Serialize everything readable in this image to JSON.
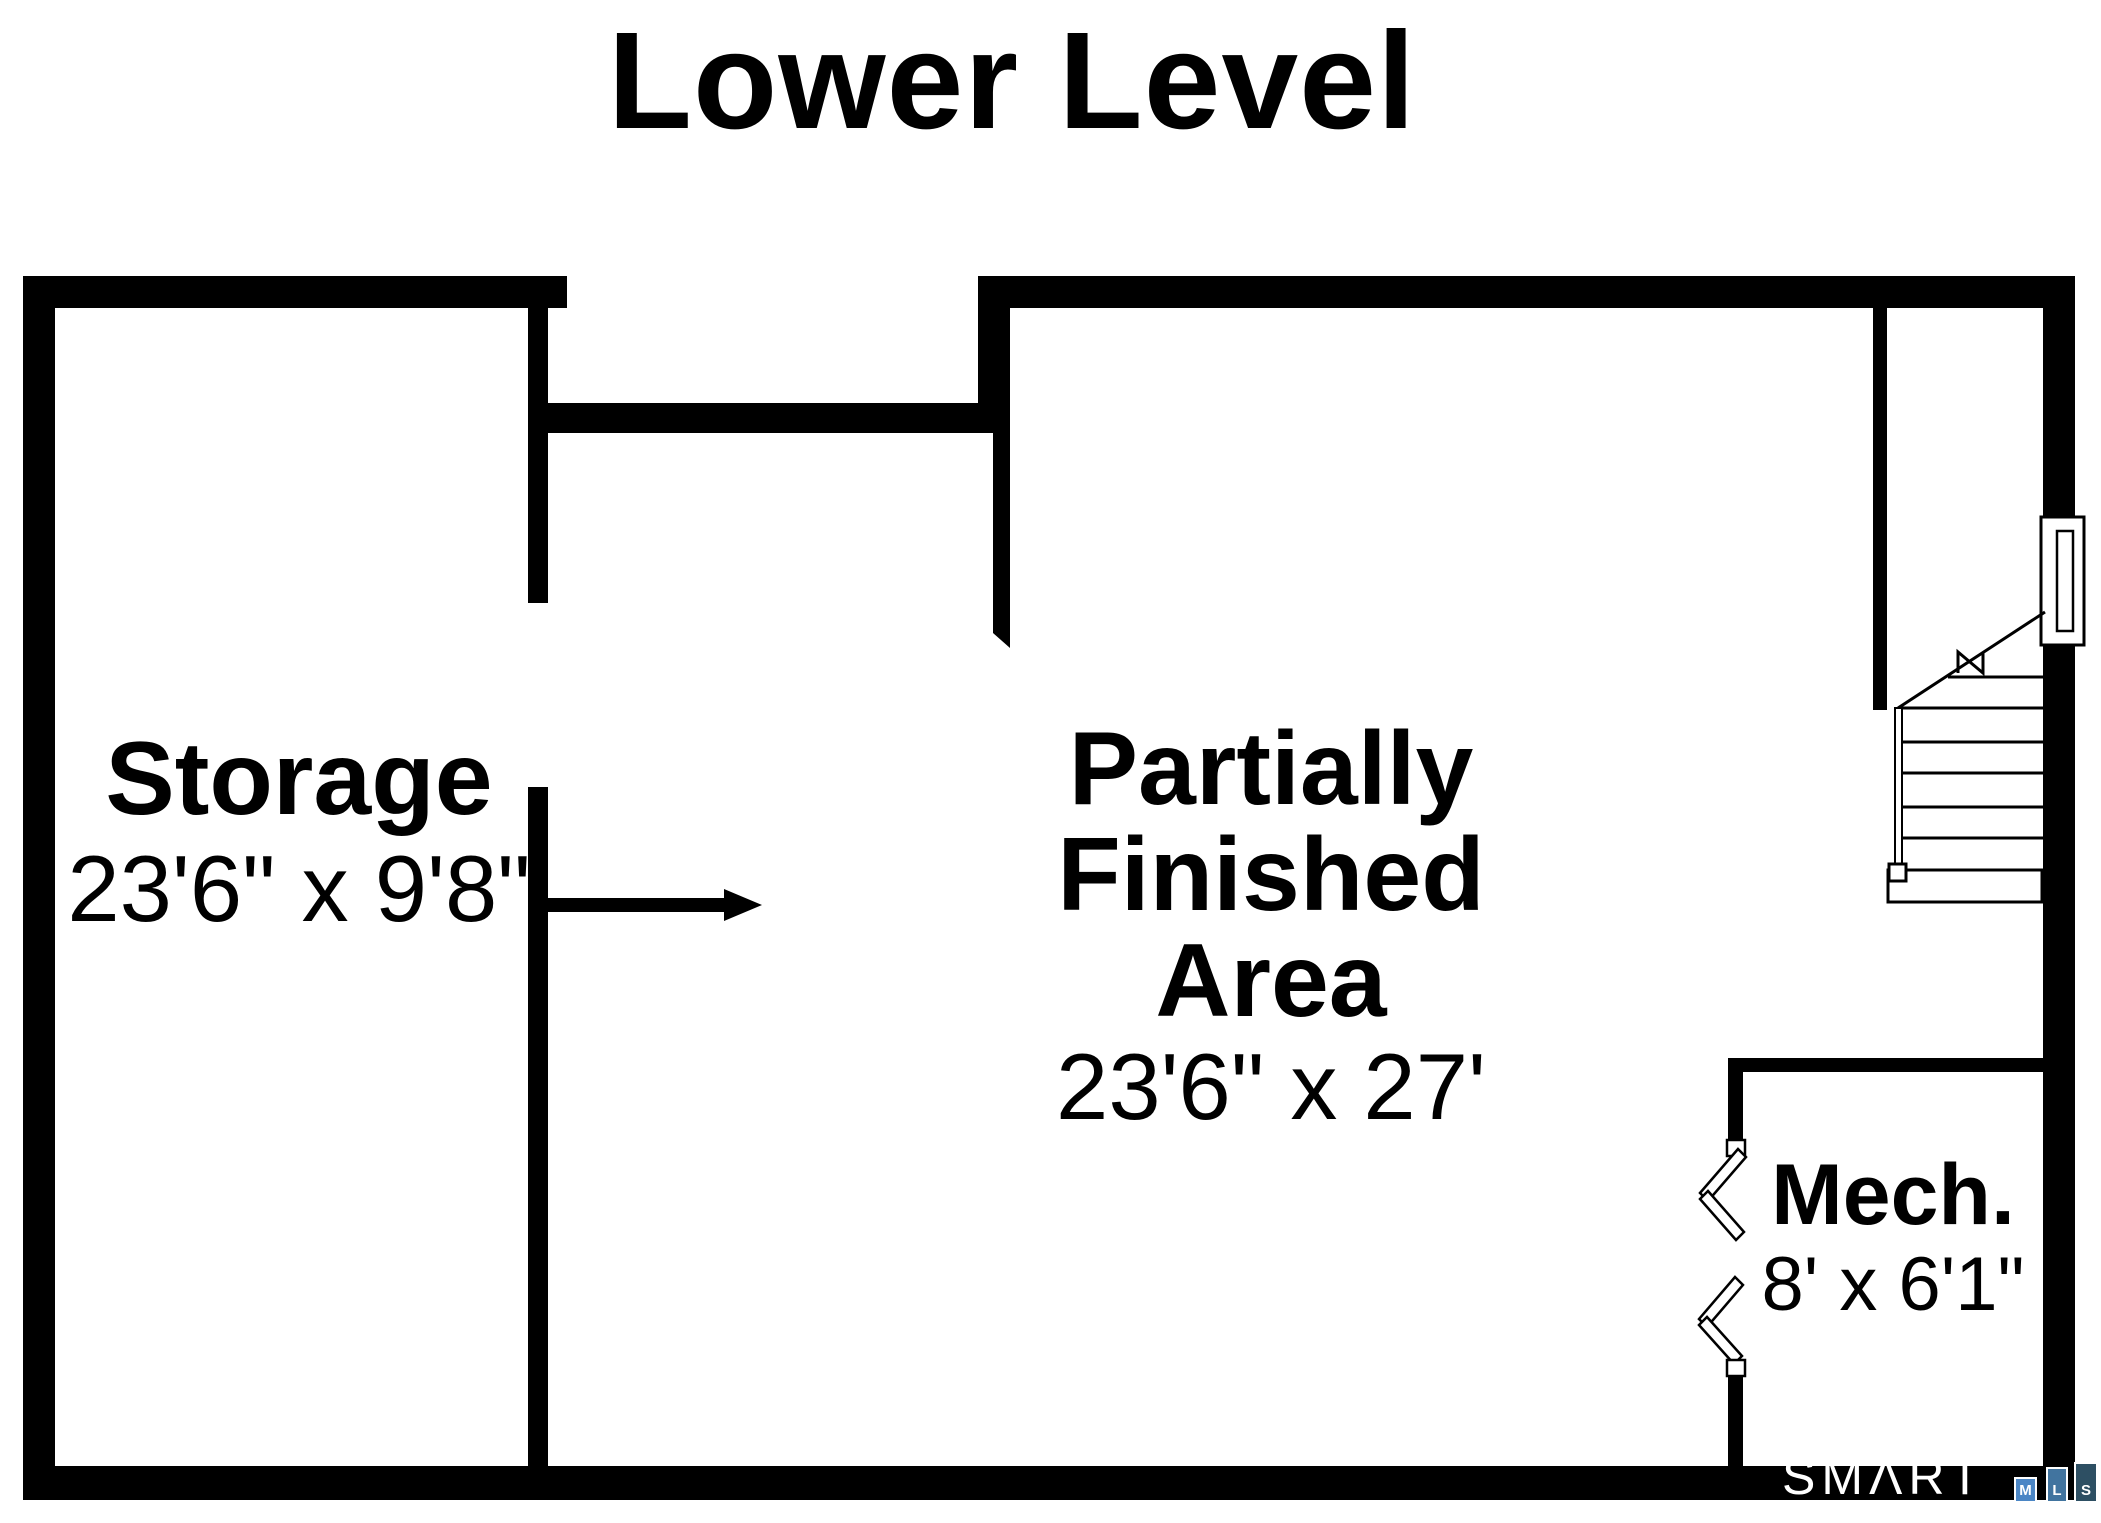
{
  "title": "Lower Level",
  "rooms": {
    "storage": {
      "name": "Storage",
      "dims": "23'6\" x 9'8\""
    },
    "partially_finished": {
      "name_line1": "Partially",
      "name_line2": "Finished",
      "name_line3": "Area",
      "dims": "23'6\" x 27'"
    },
    "mech": {
      "name": "Mech.",
      "dims": "8' x 6'1\""
    }
  },
  "logo": {
    "brand": "SMΛRT",
    "squares": [
      {
        "letter": "M",
        "color": "#4b86c5"
      },
      {
        "letter": "L",
        "color": "#41749f"
      },
      {
        "letter": "S",
        "color": "#2d4f63"
      }
    ]
  },
  "colors": {
    "wall": "#000000",
    "background": "#ffffff",
    "text": "#000000",
    "logo_text": "#ffffff"
  }
}
